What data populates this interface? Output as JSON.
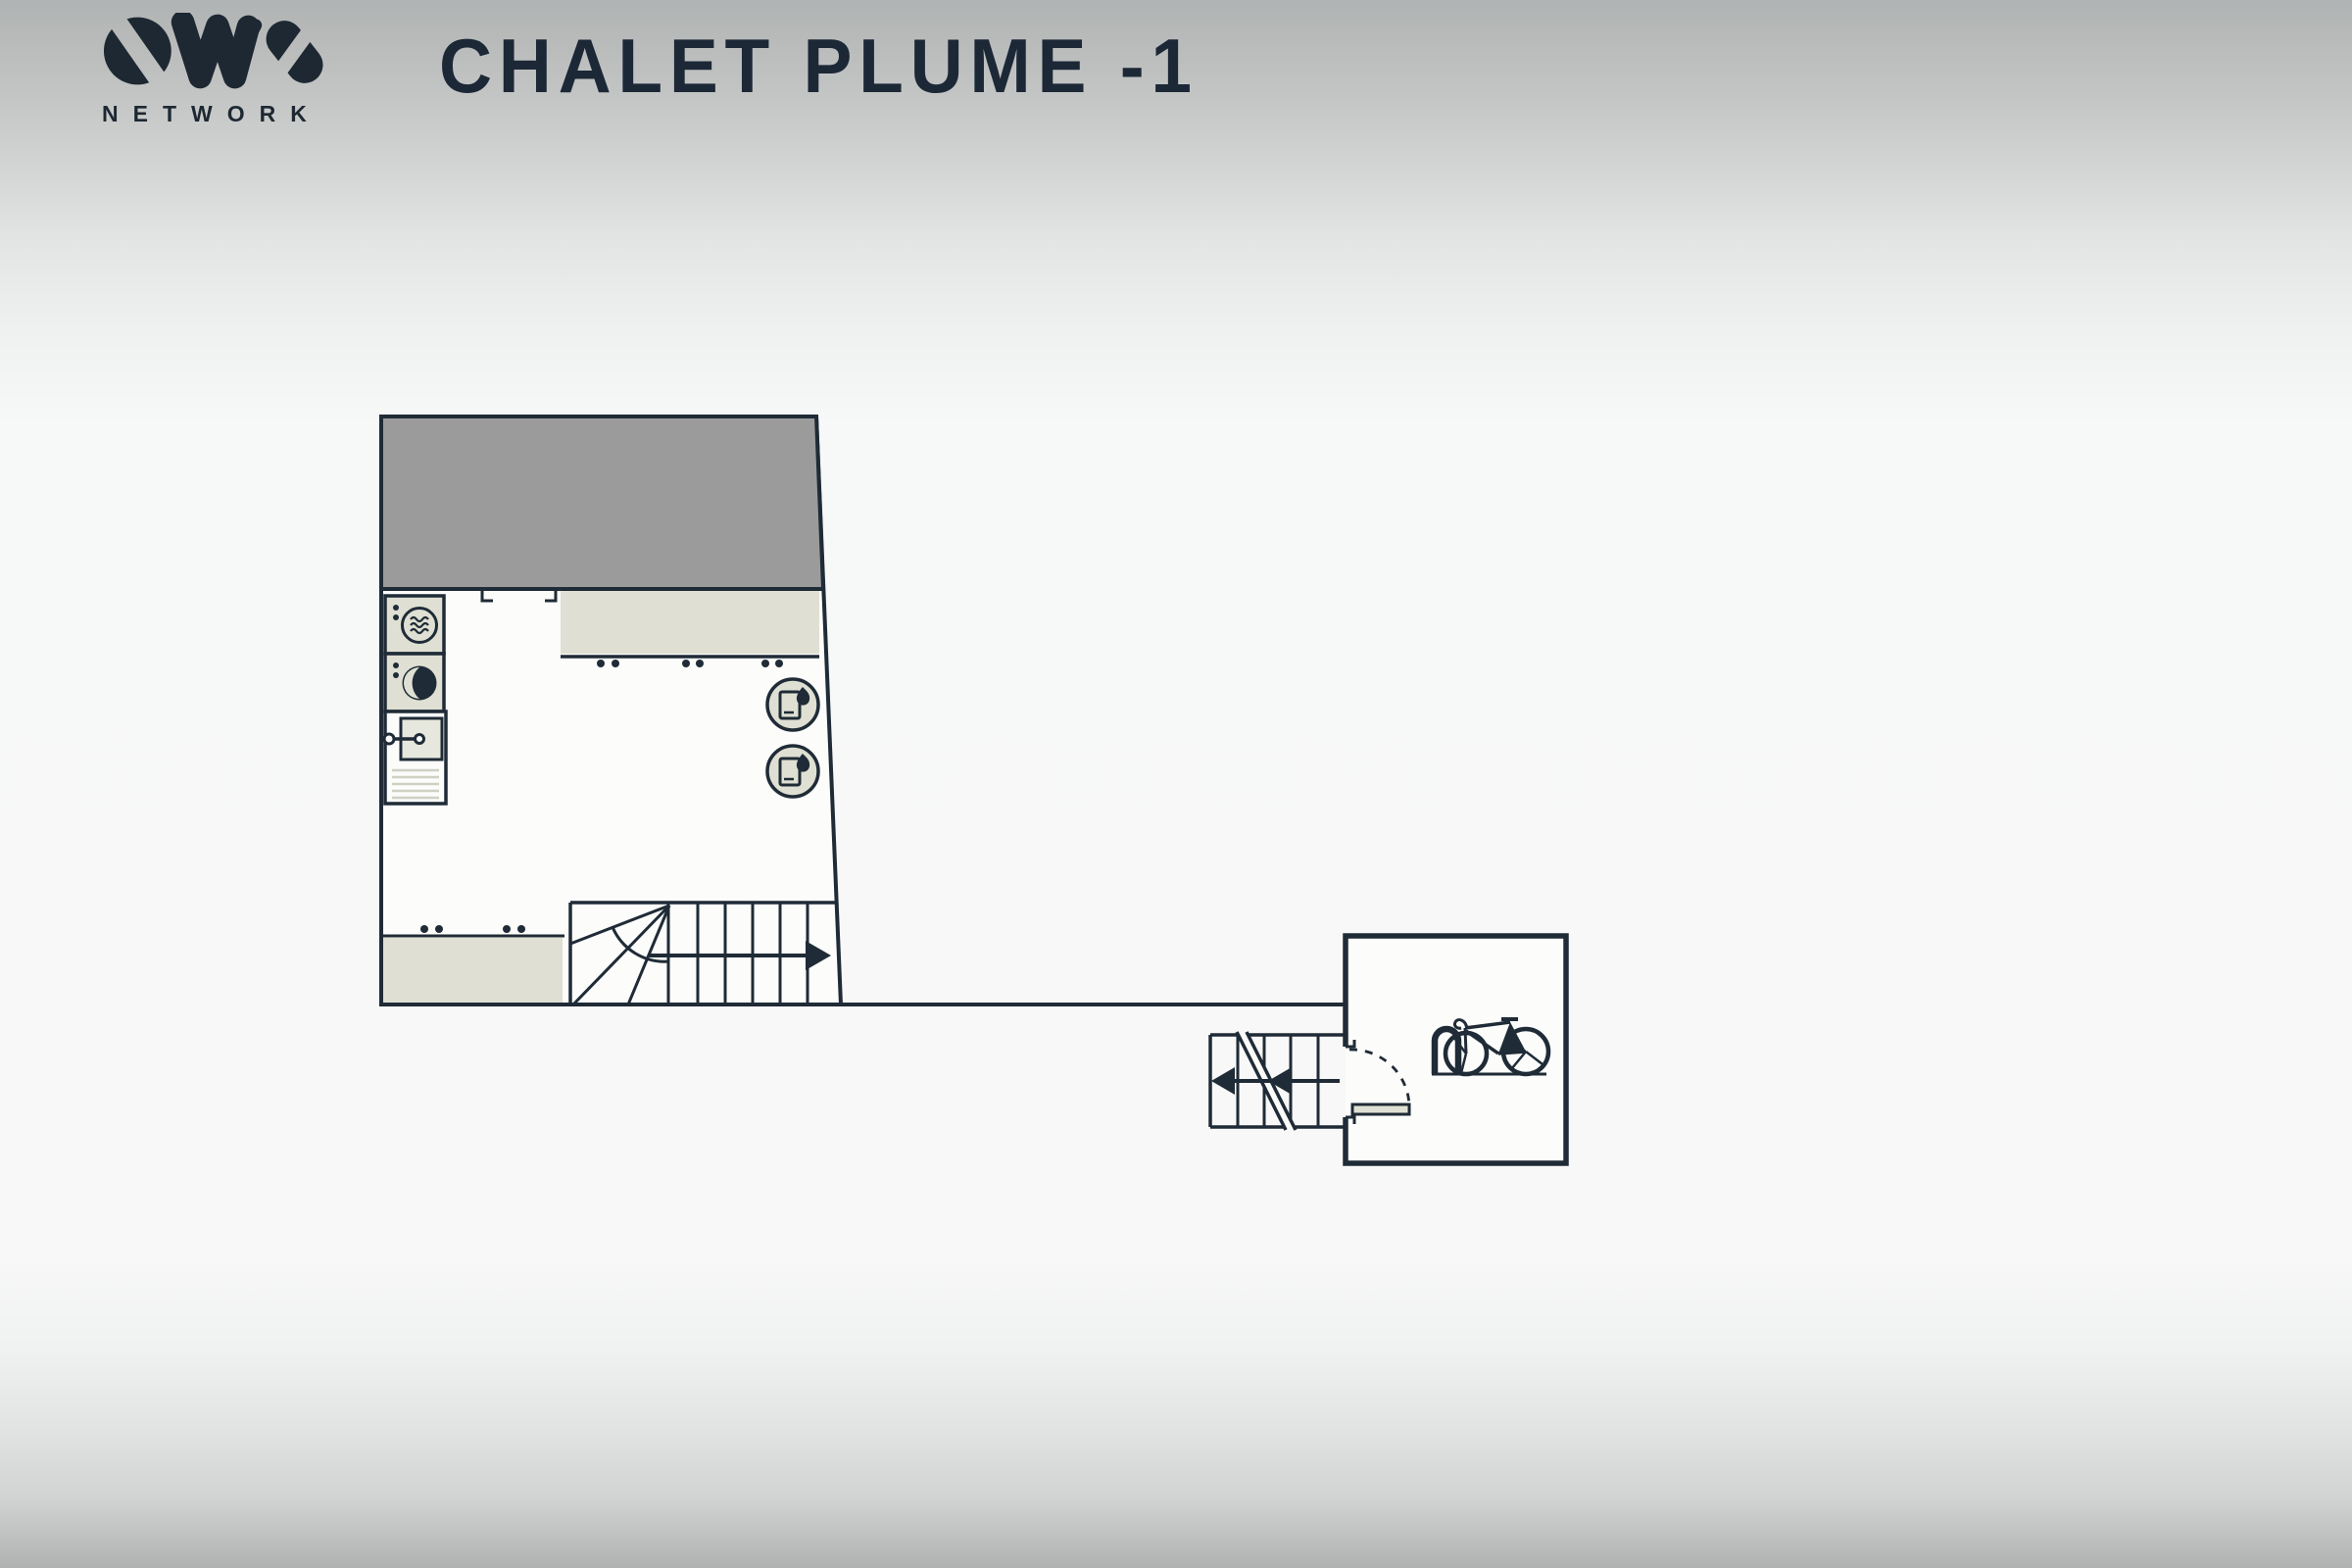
{
  "header": {
    "title": "CHALET PLUME -1"
  },
  "logo": {
    "brand": "OVO",
    "wordmark": "NETWORK"
  },
  "colors": {
    "ink": "#1f2b36",
    "wall": "#1f2b36",
    "garage_gray": "#9b9b9b",
    "furniture_beige": "#dfe0d3",
    "room_fill": "#fcfcfb",
    "background": "#f8f8f8",
    "edge_gradient": "#b1b3b3"
  },
  "floor_plan": {
    "level": "-1",
    "icons": [
      {
        "name": "washing-machine-icon",
        "count": 1
      },
      {
        "name": "tumble-dryer-icon",
        "count": 1
      },
      {
        "name": "utility-cabinet-icon",
        "count": 1
      },
      {
        "name": "water-heater-icon",
        "count": 2
      },
      {
        "name": "stairs-direction-arrow-icon",
        "count": 1
      },
      {
        "name": "exterior-steps-arrow-icon",
        "count": 2
      },
      {
        "name": "door-swing-arc-icon",
        "count": 1
      },
      {
        "name": "bicycle-parking-icon",
        "count": 1
      }
    ]
  }
}
